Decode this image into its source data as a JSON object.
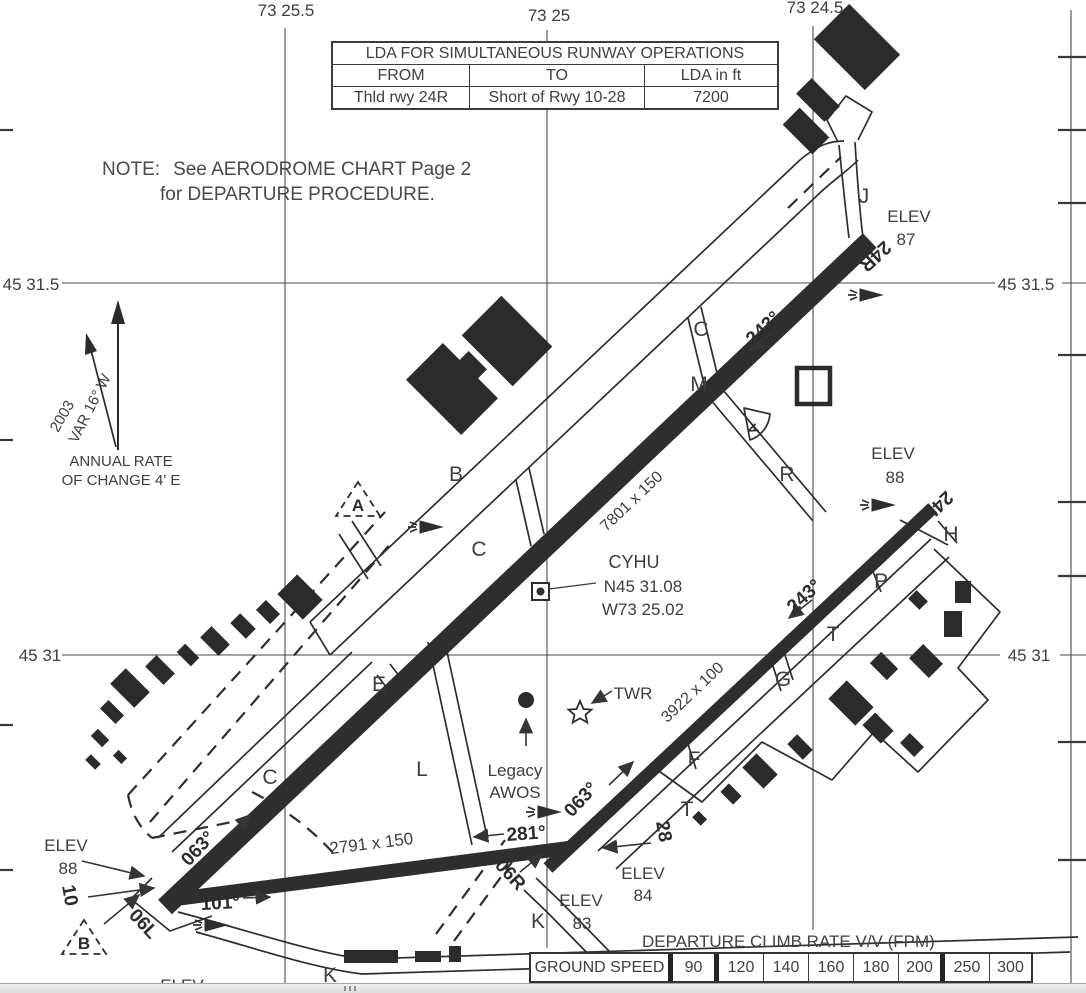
{
  "graticule": {
    "lon1": "73 25.5",
    "lon2": "73 25",
    "lon3": "73 24.5",
    "lat1": "45 31.5",
    "lat2": "45 31"
  },
  "lda_table": {
    "title": "LDA FOR SIMULTANEOUS RUNWAY OPERATIONS",
    "col_from": "FROM",
    "col_to": "TO",
    "col_lda": "LDA in ft",
    "row_from": "Thld rwy 24R",
    "row_to": "Short of Rwy 10-28",
    "row_lda": "7200"
  },
  "note": {
    "prefix": "NOTE:",
    "line1": "See AERODROME CHART Page 2",
    "line2": "for DEPARTURE PROCEDURE."
  },
  "variation": {
    "var": "VAR 16° W",
    "year": "2003",
    "rate_line1": "ANNUAL RATE",
    "rate_line2": "OF CHANGE 4' E"
  },
  "airport": {
    "icao": "CYHU",
    "lat": "N45 31.08",
    "lon": "W73 25.02"
  },
  "facilities": {
    "tower": "TWR",
    "awos_line1": "Legacy",
    "awos_line2": "AWOS"
  },
  "runways": {
    "main": {
      "dim": "7801 x 150",
      "end_sw": "06L",
      "end_ne": "24R"
    },
    "parallel": {
      "dim": "3922 x 100",
      "end_sw": "06R",
      "end_ne": "24L"
    },
    "cross": {
      "dim": "2791 x 150",
      "end_w": "10",
      "end_e": "28"
    },
    "hdg_ne": "063°",
    "hdg_sw": "243°",
    "hdg_e": "101°",
    "hdg_w": "281°"
  },
  "elev": {
    "word": "ELEV",
    "rwy24r": "87",
    "rwy24l": "88",
    "rwy06l": "88",
    "rwy28": "84",
    "rwy06r": "83"
  },
  "taxiways": {
    "a": "A",
    "b": "B",
    "c": "C",
    "e": "E",
    "f": "F",
    "g": "G",
    "h": "H",
    "j": "J",
    "k": "K",
    "l": "L",
    "m": "M",
    "p": "P",
    "r": "R",
    "t": "T"
  },
  "holds": {
    "a": "A",
    "b": "B"
  },
  "climb_table": {
    "title": "DEPARTURE CLIMB RATE V/V (FPM)",
    "row_label": "GROUND SPEED",
    "speeds": [
      "90",
      "120",
      "140",
      "160",
      "180",
      "200",
      "250",
      "300"
    ]
  }
}
